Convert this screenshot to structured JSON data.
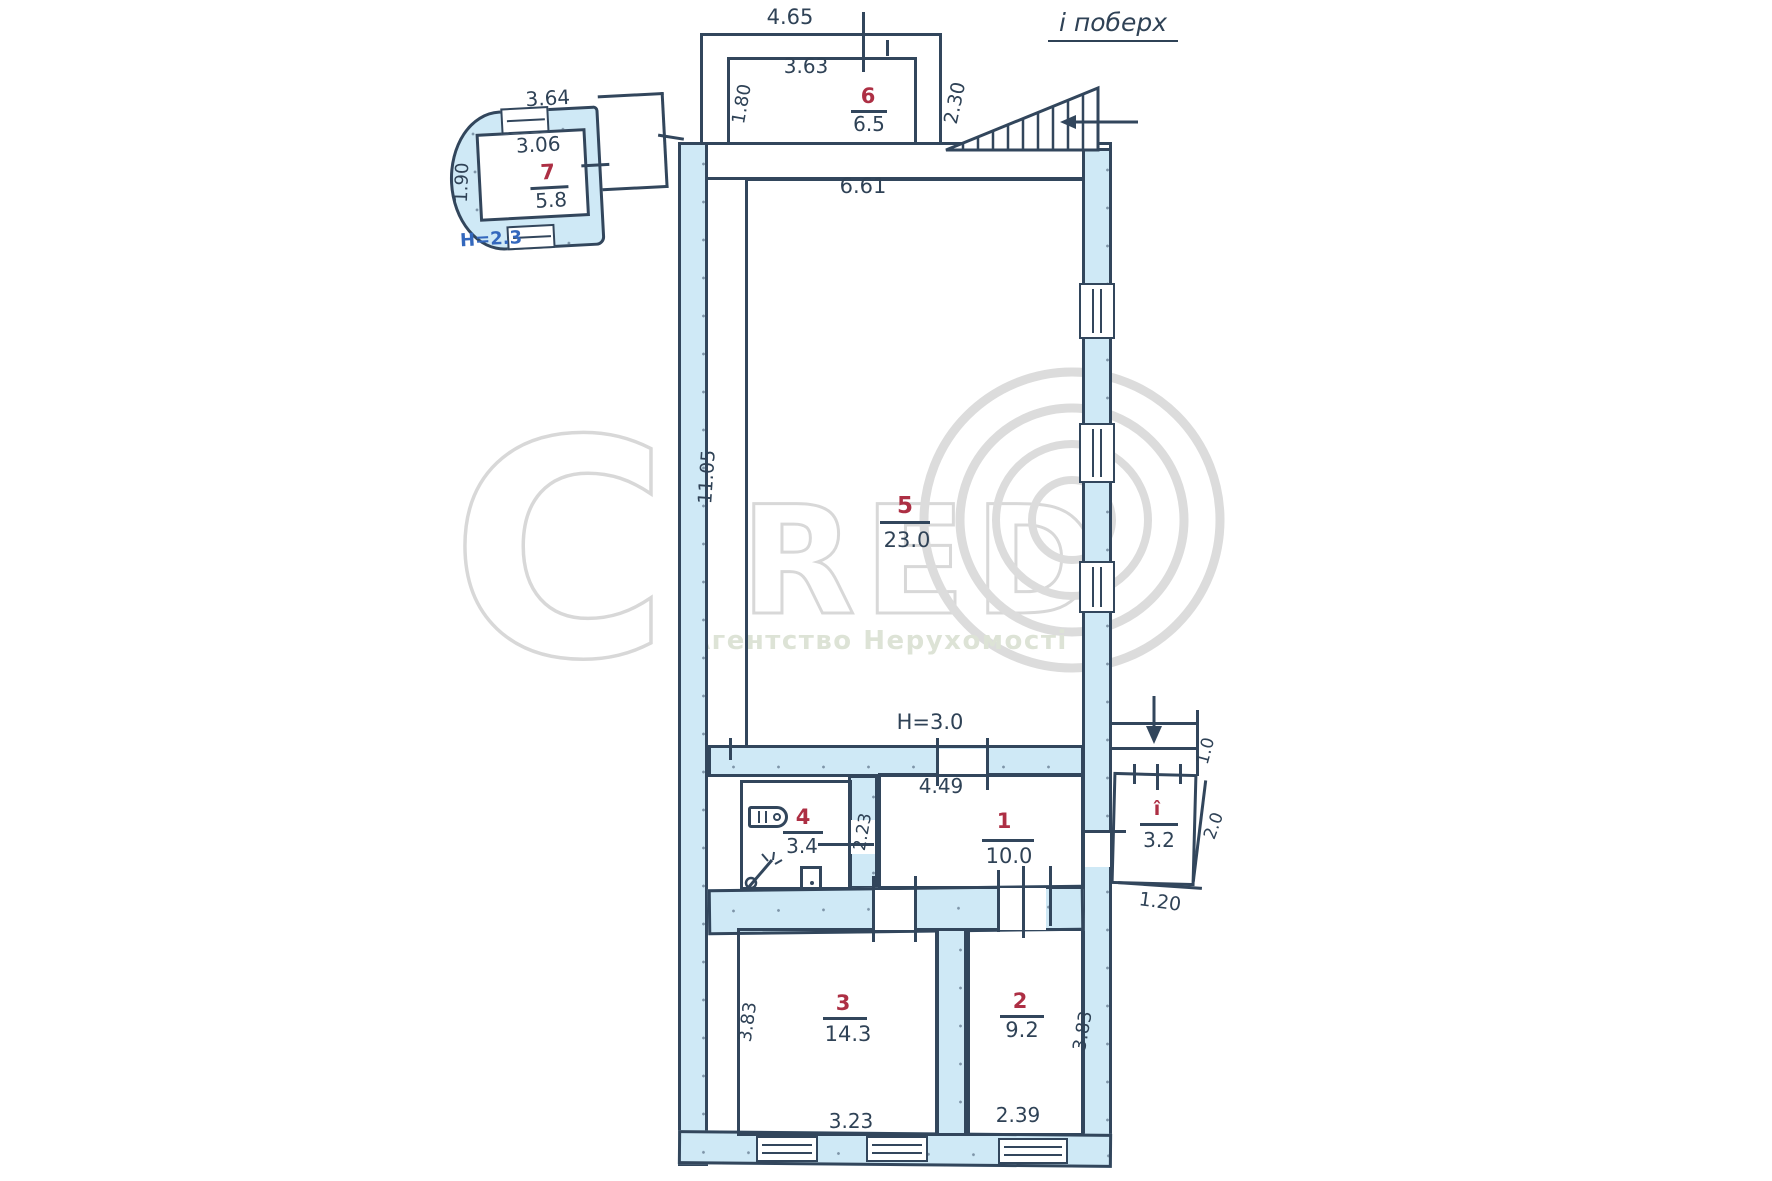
{
  "title": "і поберх",
  "watermark": {
    "c": "C",
    "red": "RED",
    "caption": "Агентство Нерухомості"
  },
  "annex": {
    "number": "7",
    "area": "5.8",
    "dim_top": "3.64",
    "dim_inner": "3.06",
    "dim_left": "1.90",
    "height": "H=2.3"
  },
  "room6": {
    "number": "6",
    "area": "6.5",
    "dim_top": "4.65",
    "dim_inner": "3.63",
    "dim_left": "1.80",
    "dim_right": "2.30"
  },
  "room5": {
    "number": "5",
    "area": "23.0",
    "dim_top": "6.61",
    "dim_left": "11.05",
    "height": "H=3.0"
  },
  "room4": {
    "number": "4",
    "area": "3.4"
  },
  "room1": {
    "number": "1",
    "area": "10.0",
    "dim_top": "4.49",
    "dim_door": "2.23"
  },
  "room3": {
    "number": "3",
    "area": "14.3",
    "dim_left": "3.83",
    "dim_bottom": "3.23"
  },
  "room2": {
    "number": "2",
    "area": "9.2",
    "dim_right": "3.83",
    "dim_bottom": "2.39"
  },
  "porch": {
    "number": "î",
    "area": "3.2",
    "dim_top": "1.0",
    "dim_side": "2.0",
    "dim_bottom": "1.20"
  }
}
